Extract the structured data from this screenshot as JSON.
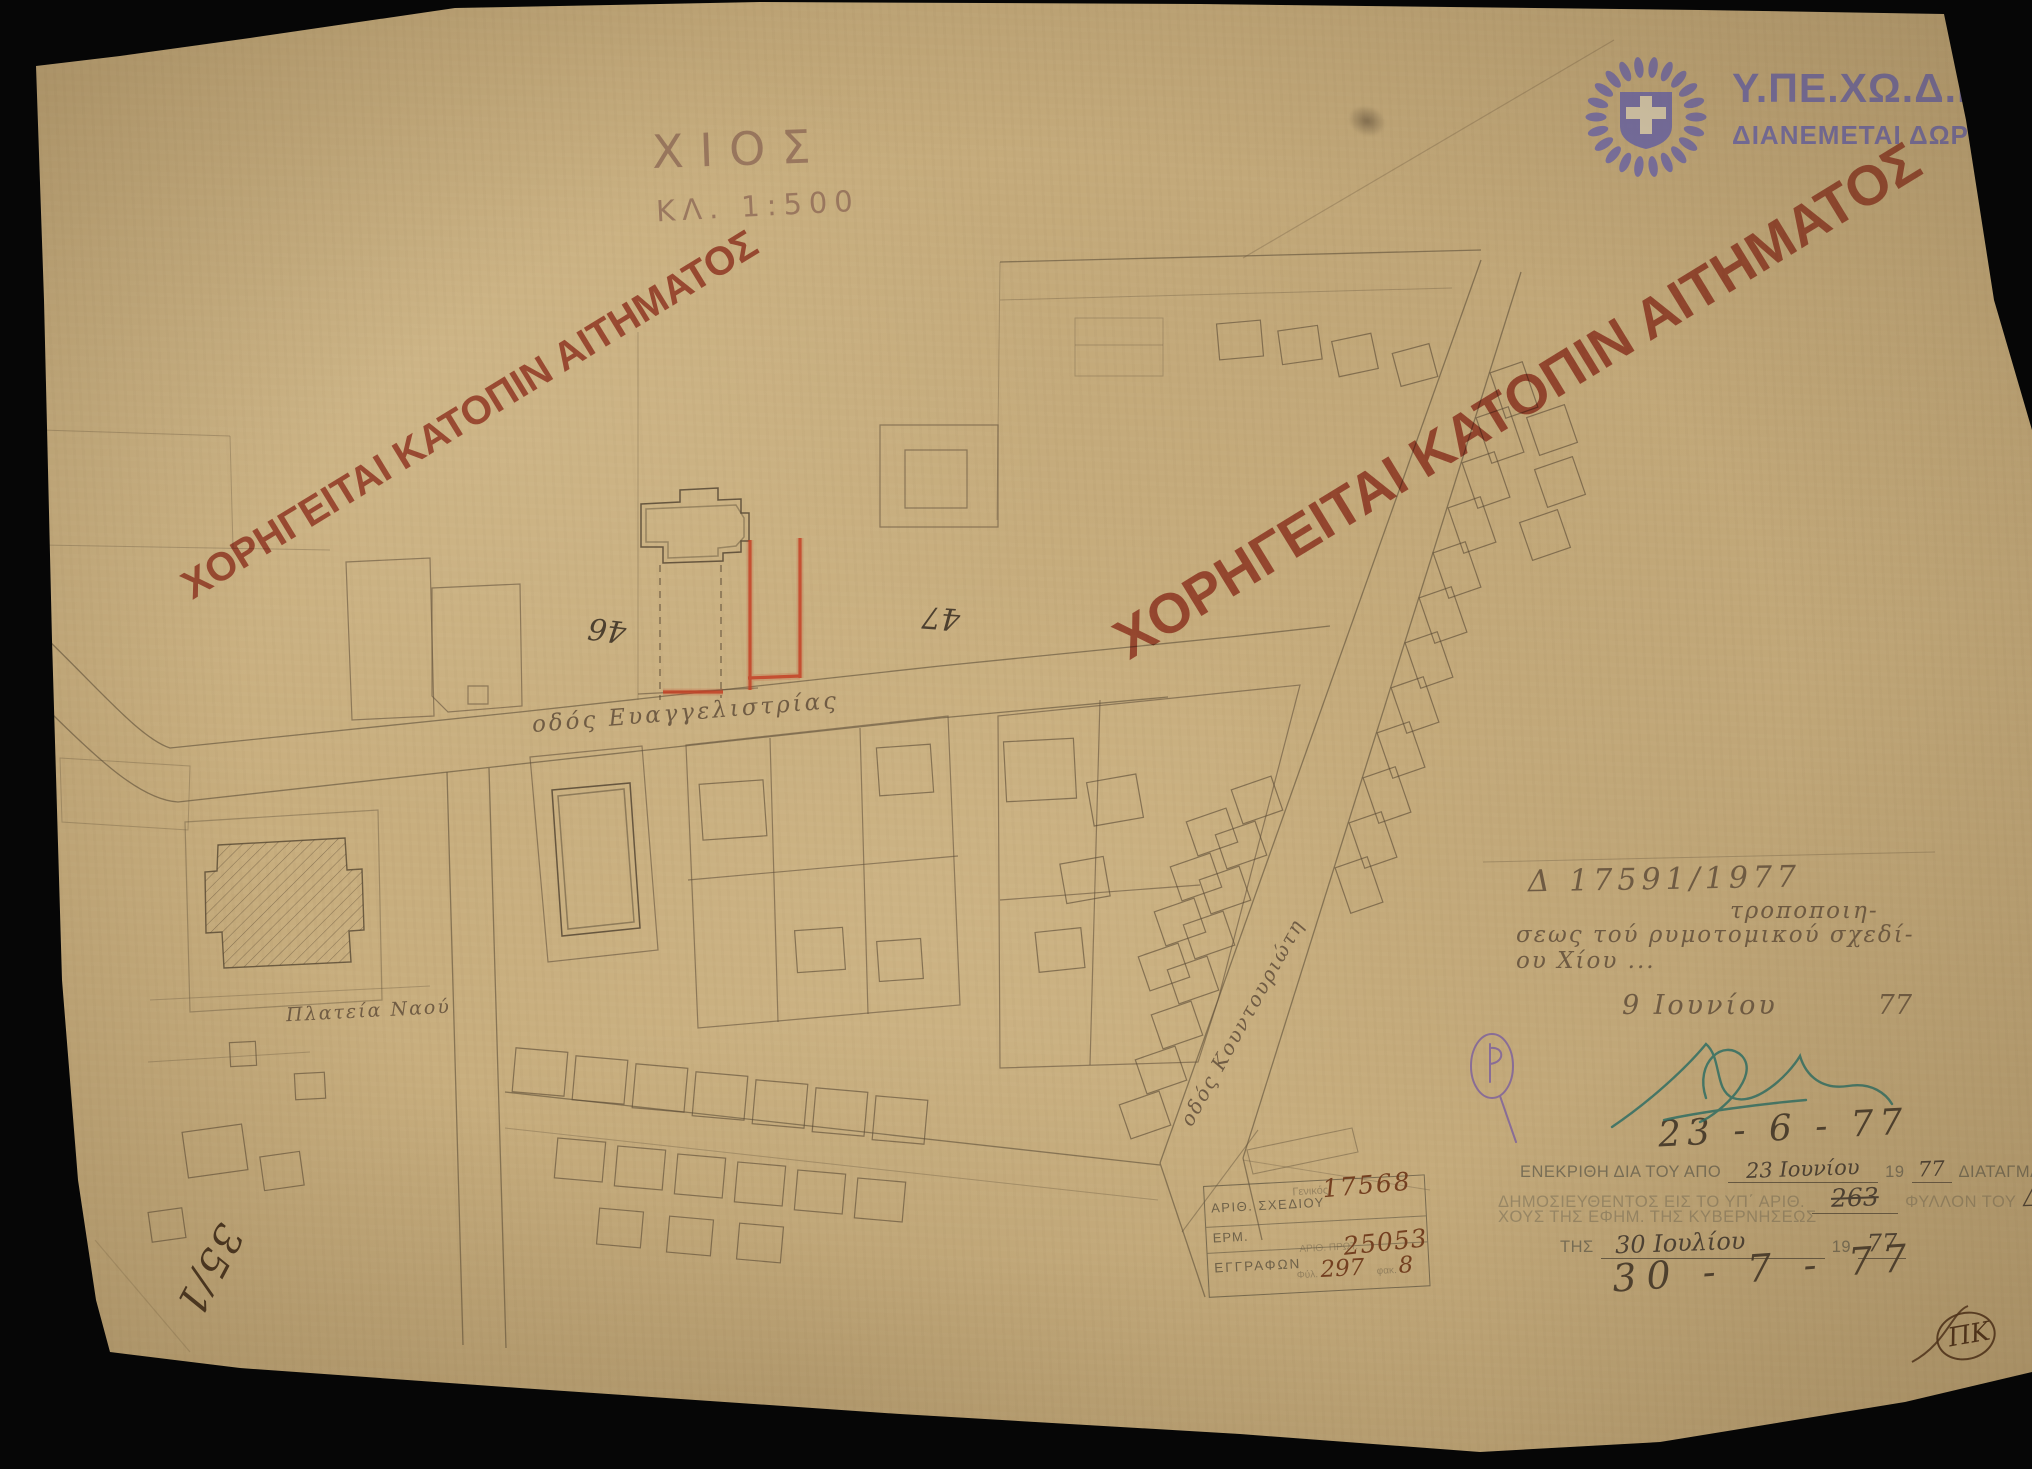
{
  "scan": {
    "title": "ΧΙΟΣ",
    "scale": "ΚΛ. 1:500",
    "watermark_left": "ΧΟΡΗΓΕΙΤΑΙ ΚΑΤΟΠΙΝ ΑΙΤΗΜΑΤΟΣ",
    "watermark_right": "ΧΟΡΗΓΕΙΤΑΙ ΚΑΤΟΠΙΝ ΑΙΤΗΜΑΤΟΣ",
    "colors": {
      "paper": "#c8ae7e",
      "watermark_red": "#b1473a",
      "logo_purple": "#6f69a8",
      "correction_red": "#c43f24"
    }
  },
  "logo": {
    "ministry": "Υ.ΠΕ.ΧΩ.Δ.Ε.",
    "distribution": "ΔΙΑΝΕΜΕΤΑΙ ΔΩΡΕΑΝ"
  },
  "map_labels": {
    "street_main": "οδός Ευαγγελιστρίας",
    "street_diagonal": "οδός Κουντουριώτη",
    "square": "Πλατεία Ναού",
    "block_46": "46",
    "block_47": "47"
  },
  "annotations": {
    "decree_line1": "Δ 17591/1977",
    "decree_line2": "τροποποιη-",
    "decree_line3": "σεως τού ρυμοτομικού σχεδί-",
    "decree_line4": "ου Χίου ...",
    "note_date": "9 Ιουνίου",
    "note_date_year": "77",
    "date_pencil_top": "23 - 6 - 77",
    "date_pencil_bottom": "30 - 7 - 77",
    "sheet_ref": "35/1",
    "monogram": "ΠΚ"
  },
  "stamp": {
    "l1a": "ΕΝΕΚΡΙΘΗ ΔΙΑ ΤΟΥ ΑΠΟ",
    "l1_date": "23 Ιουνίου",
    "l1_year_prefix": "19",
    "l1_year": "77",
    "l1b": "ΔΙΑΤΑΓΜΑΤΟΣ",
    "l2a": "ΔΗΜΟΣΙΕΥΘΕΝΤΟΣ ΕΙΣ ΤΟ ΥΠ΄ ΑΡΙΘ.",
    "l2_number": "263",
    "l2b": "ΦΥΛΛΟΝ ΤΟΥ",
    "l2_letter": "Δ",
    "l2c": "ΤΕΥ-",
    "l3": "ΧΟΥΣ ΤΗΣ ΕΦΗΜ. ΤΗΣ ΚΥΒΕΡΝΗΣΕΩΣ",
    "l4a": "ΤΗΣ",
    "l4_date": "30 Ιουλίου",
    "l4_year_prefix": "19",
    "l4_year": "77"
  },
  "registry_box": {
    "row1_label": "ΑΡΙΘ. ΣΧΕΔΙΟΥ",
    "row1_sub": "Γενικός",
    "row1_value": "17568",
    "row2_label": "ΕΡΜ.",
    "row3_label": "ΕΓΓΡΑΦΩΝ",
    "row3_sub": "ΑΡΙΘ. ΠΡΩΤ.",
    "row3_value": "25053",
    "row4_folio_label": "Φύλ.",
    "row4_folio_value": "297",
    "row4_file_label": "φακ.",
    "row4_file_value": "8"
  }
}
